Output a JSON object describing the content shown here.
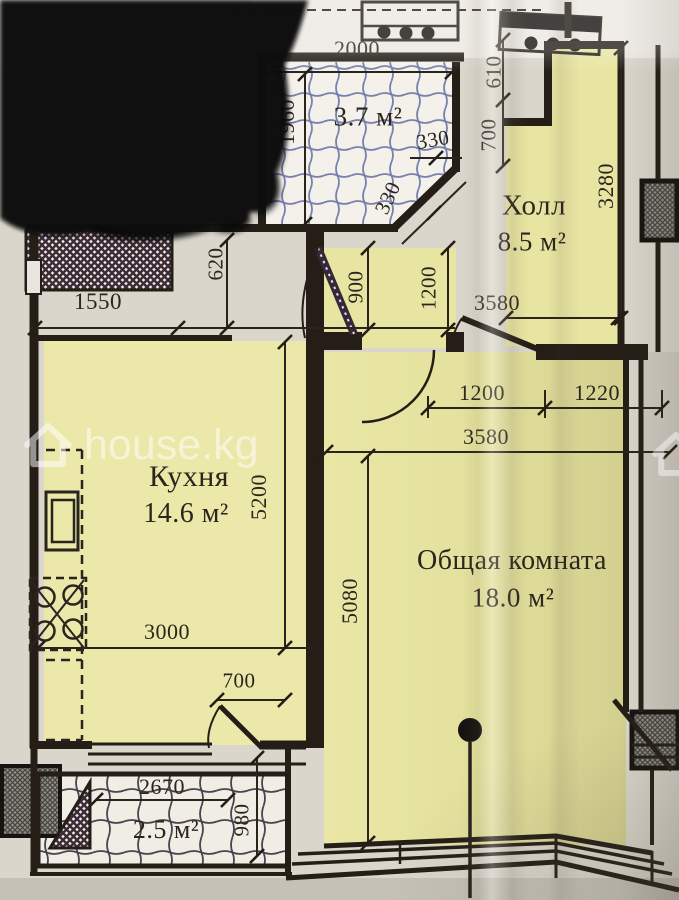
{
  "watermark": {
    "label": "house.kg"
  },
  "rooms": {
    "bathroom": {
      "area": "3.7 м²"
    },
    "hall": {
      "name": "Холл",
      "area": "8.5 м²"
    },
    "kitchen": {
      "name": "Кухня",
      "area": "14.6 м²"
    },
    "living": {
      "name": "Общая комната",
      "area": "18.0 м²"
    },
    "balcony": {
      "area": "2.5 м²"
    }
  },
  "dims": {
    "bath_width": "2000",
    "bath_height": "1960",
    "bath_chamfer_a": "330",
    "bath_chamfer_b": "330",
    "hall_setback_top": "610",
    "hall_setback_bottom": "700",
    "hall_right": "3280",
    "hall_width": "3580",
    "entry_depth": "900",
    "entry_width": "1200",
    "niche_width": "1550",
    "niche_depth": "620",
    "living_door_left": "1200",
    "living_door_right": "1220",
    "living_width": "3580",
    "living_height": "5080",
    "kitchen_height": "5200",
    "kitchen_width": "3000",
    "balcony_door": "700",
    "balcony_width": "2670",
    "balcony_depth": "980"
  },
  "colors": {
    "room_fill": "#e9e6a4",
    "tile_blue": "#7880ae",
    "line": "#241e17",
    "paper": "#dad6cc"
  }
}
